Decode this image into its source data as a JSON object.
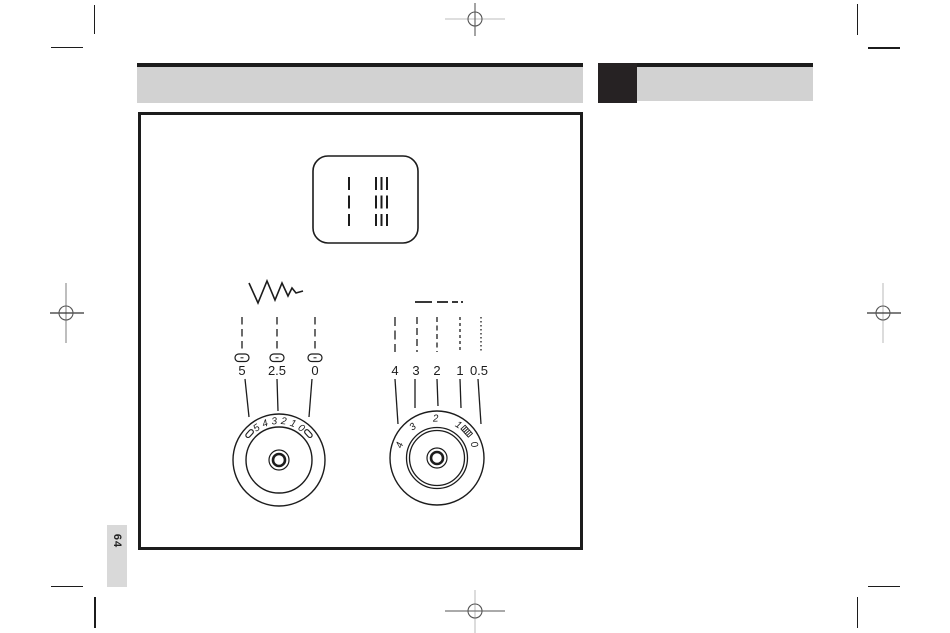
{
  "colors": {
    "bar_gray": "#d2d2d2",
    "block_black": "#262223",
    "tab_gray": "#d9d9d9",
    "ink": "#1c1c1c"
  },
  "page": {
    "number": "64"
  },
  "diagram": {
    "stitch_panel": {
      "symbols": [
        "straight-stitch",
        "triple-straight-stitch"
      ]
    },
    "stitch_width": {
      "symbol": "zigzag",
      "scale_labels": [
        "5",
        "2.5",
        "0"
      ],
      "dial_numbers": [
        "5",
        "4",
        "3",
        "2",
        "1",
        "0"
      ]
    },
    "stitch_length": {
      "symbol": "dashed-line",
      "scale_labels": [
        "4",
        "3",
        "2",
        "1",
        "0.5"
      ],
      "dial_numbers": [
        "4",
        "3",
        "2",
        "1",
        "0"
      ]
    }
  }
}
